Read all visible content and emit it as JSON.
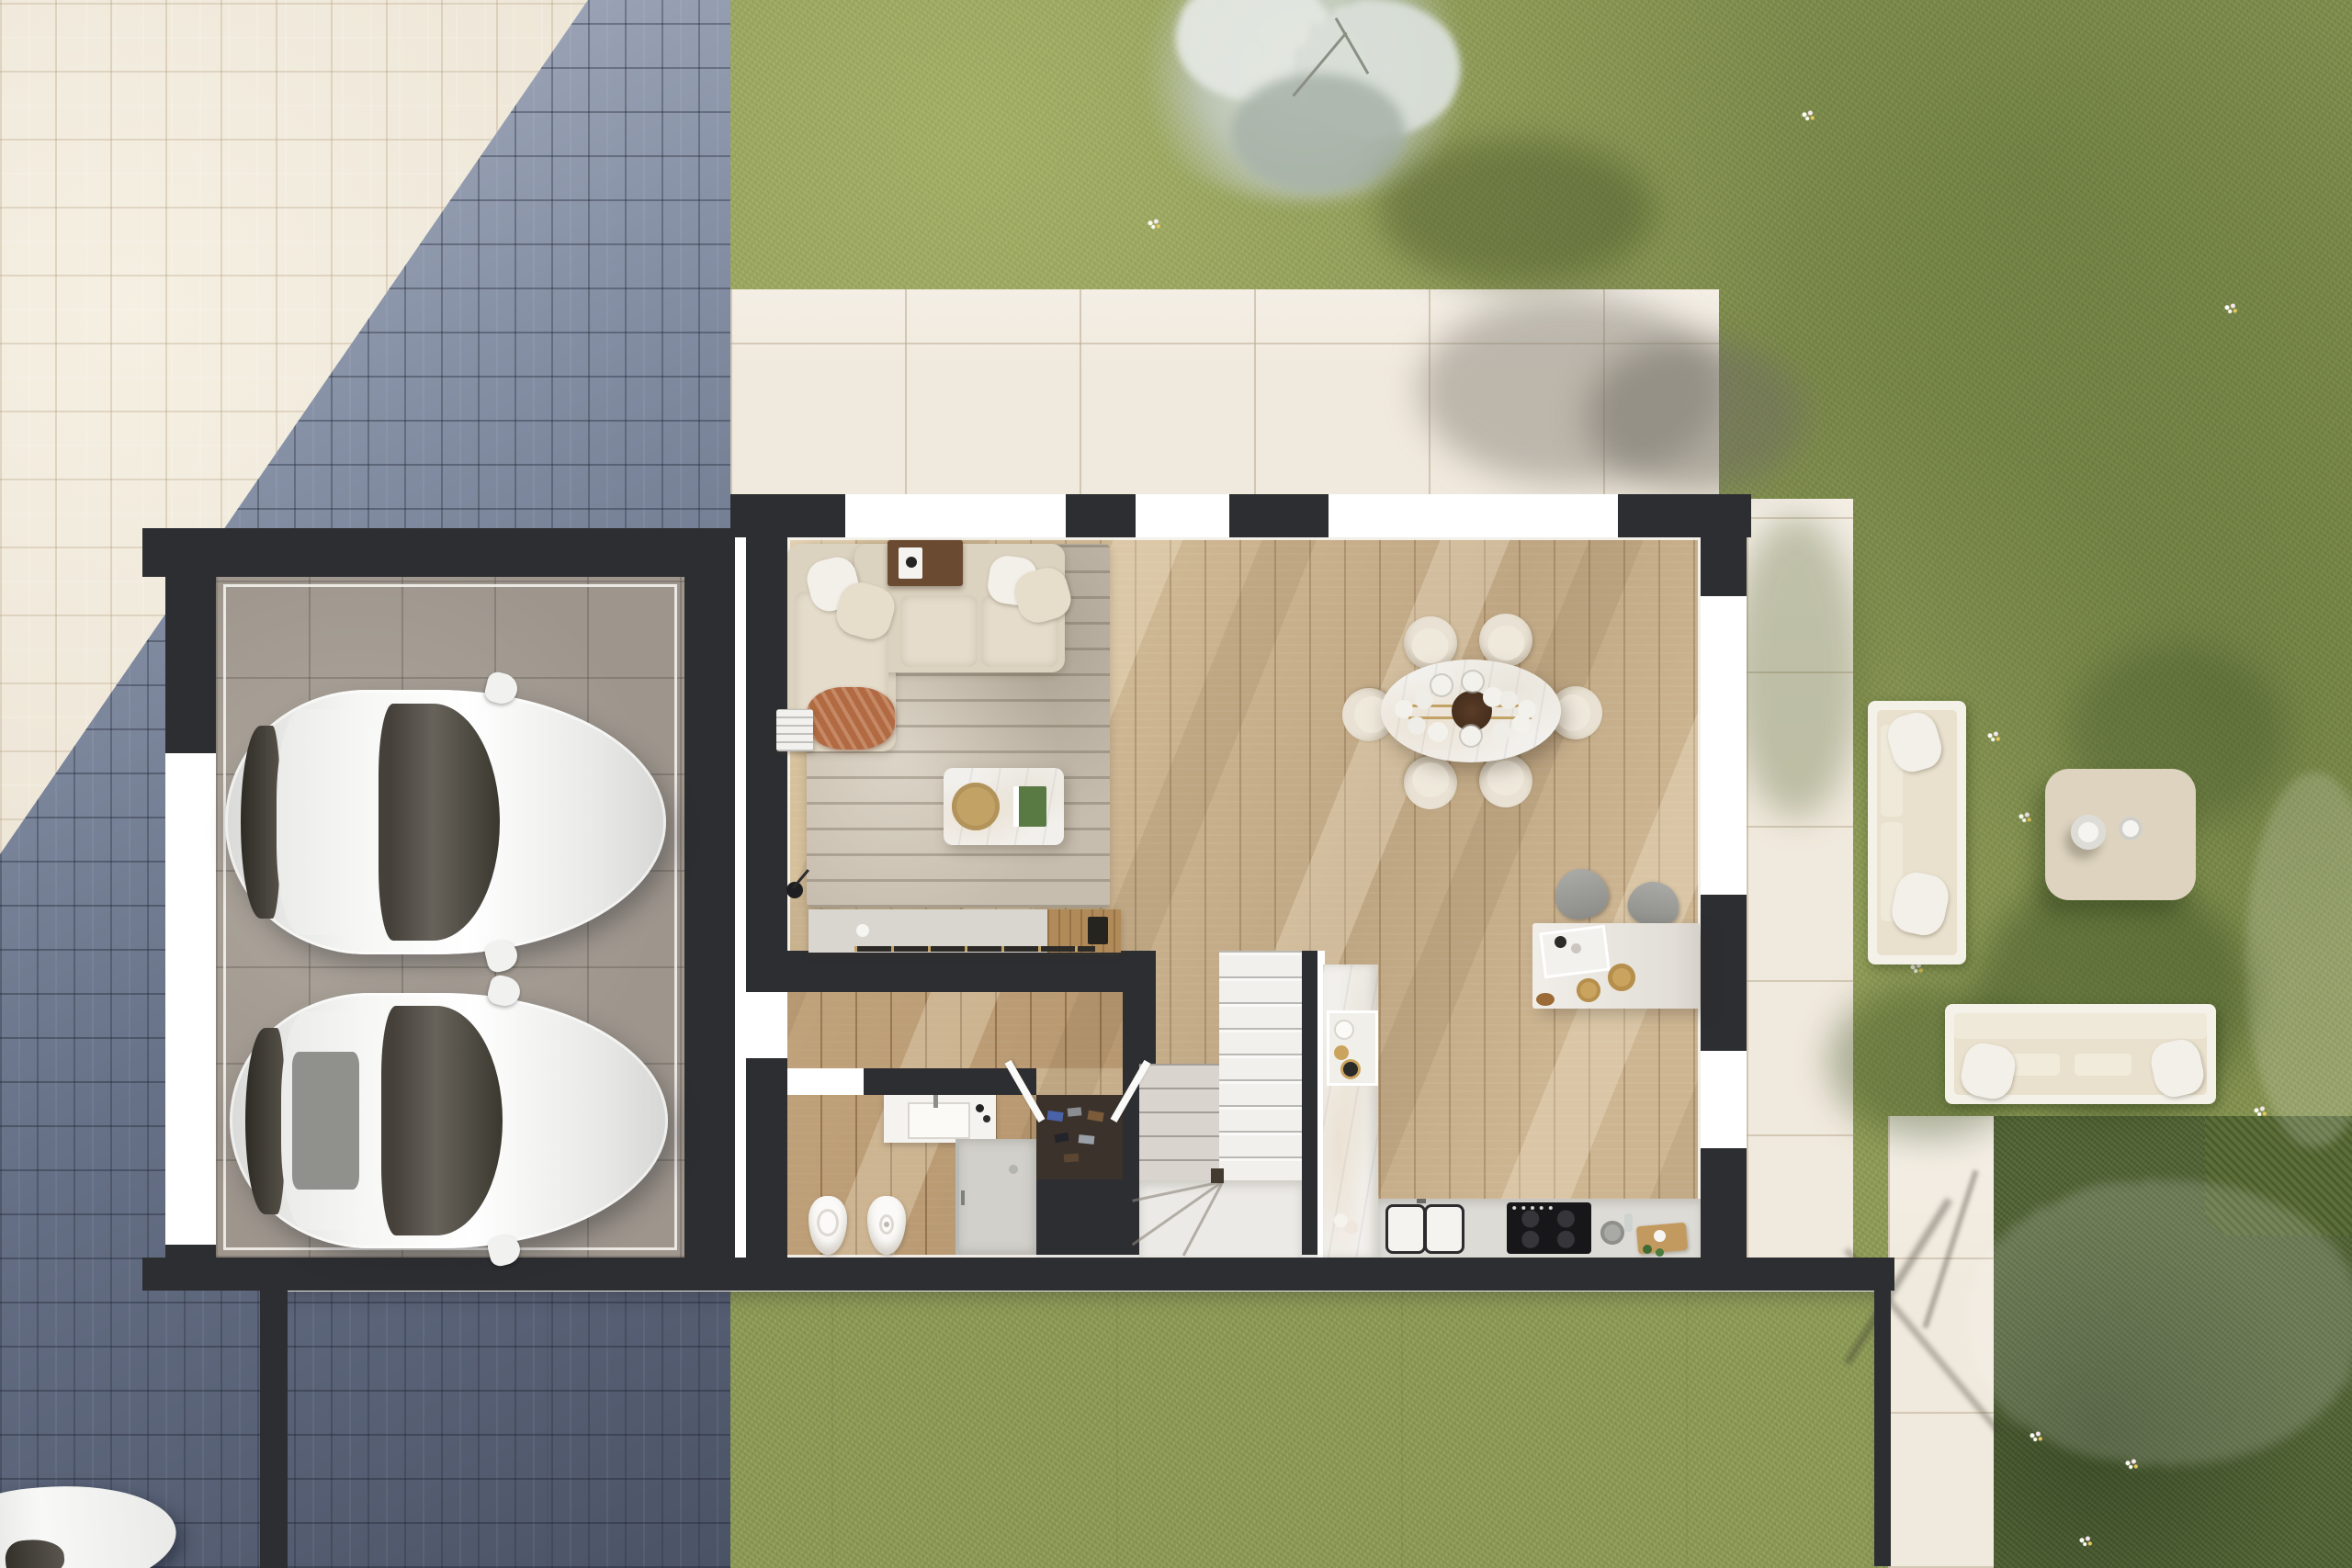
{
  "page_title": "house-ground-floor-plan-render",
  "colors": {
    "wall": "#2d2e32",
    "trim": "#f6f5f1",
    "white": "#ffffff",
    "cream": "#ebe3d4",
    "slateMid": "#76819b",
    "grass": "#8f9c58",
    "gardenDark": "#55663a",
    "hedge": "#5d6f39",
    "shrubSilver": "#ccd3c7",
    "terrace": "#f0e9dd",
    "driveway": "#d5d6d6",
    "wood": "#cdb591",
    "entryWood": "#b2946a",
    "rug": "#c7bdae",
    "sofa": "#dcd2c0",
    "cushion": "#e5dccb",
    "pillow": "#f3f0e9",
    "throw": "#b26a42",
    "walnut": "#6b4a32",
    "marble": "#f2f0ec",
    "gold": "#c3a266",
    "island": "#ebe8e2",
    "counter": "#dddbd6",
    "cooktop": "#17171a",
    "stool": "#9c9c98",
    "chair": "#e9e2d4",
    "chairSeat": "#efe9dc",
    "stairWhite": "#f1f0ed",
    "stairGray": "#d9d5ce",
    "closet": "#3a322b",
    "shower": "#d2d0cb",
    "outFrame": "#f4f1e9",
    "outCushion": "#e9e1cd",
    "outTable": "#ddd3bf",
    "carBody": "#f2f2f1",
    "carGlass": "#3c382f"
  },
  "plan": {
    "garage": {
      "parked_cars": 2,
      "floor": "gray-tile",
      "window_gaps": 1
    },
    "living_room": {
      "sectional_sofa": 1,
      "throw_pillows": 4,
      "terracotta_throw": 1,
      "rug": 1,
      "coffee_table": 1,
      "gold_tray": 1,
      "media_console": 1,
      "floor_lamp": 1,
      "console_table": 1,
      "side_table": 1
    },
    "dining_area": {
      "oval_table": 1,
      "chairs": 6,
      "chandelier_globes": 12
    },
    "kitchen": {
      "island": 1,
      "bar_stools": 2,
      "cooktop": 1,
      "sink_basins": 2,
      "counter_runs": 2,
      "serving_plates": 2,
      "tray": 2
    },
    "bathroom": {
      "toilet": 1,
      "bidet": 1,
      "vanity": 1,
      "shower": 1
    },
    "entry": {
      "front_door": 1,
      "wardrobe_with_shoes": 1,
      "double_doors": 2
    },
    "stairs": {
      "flights": 2,
      "winder_landing": 1
    },
    "outdoor": {
      "lounge_sofas": 2,
      "square_coffee_table": 1,
      "bowls_on_table": 2,
      "blossom_tree": 1,
      "silver_shrubs": 2,
      "flower_patches": 10,
      "street_car": 1
    }
  }
}
